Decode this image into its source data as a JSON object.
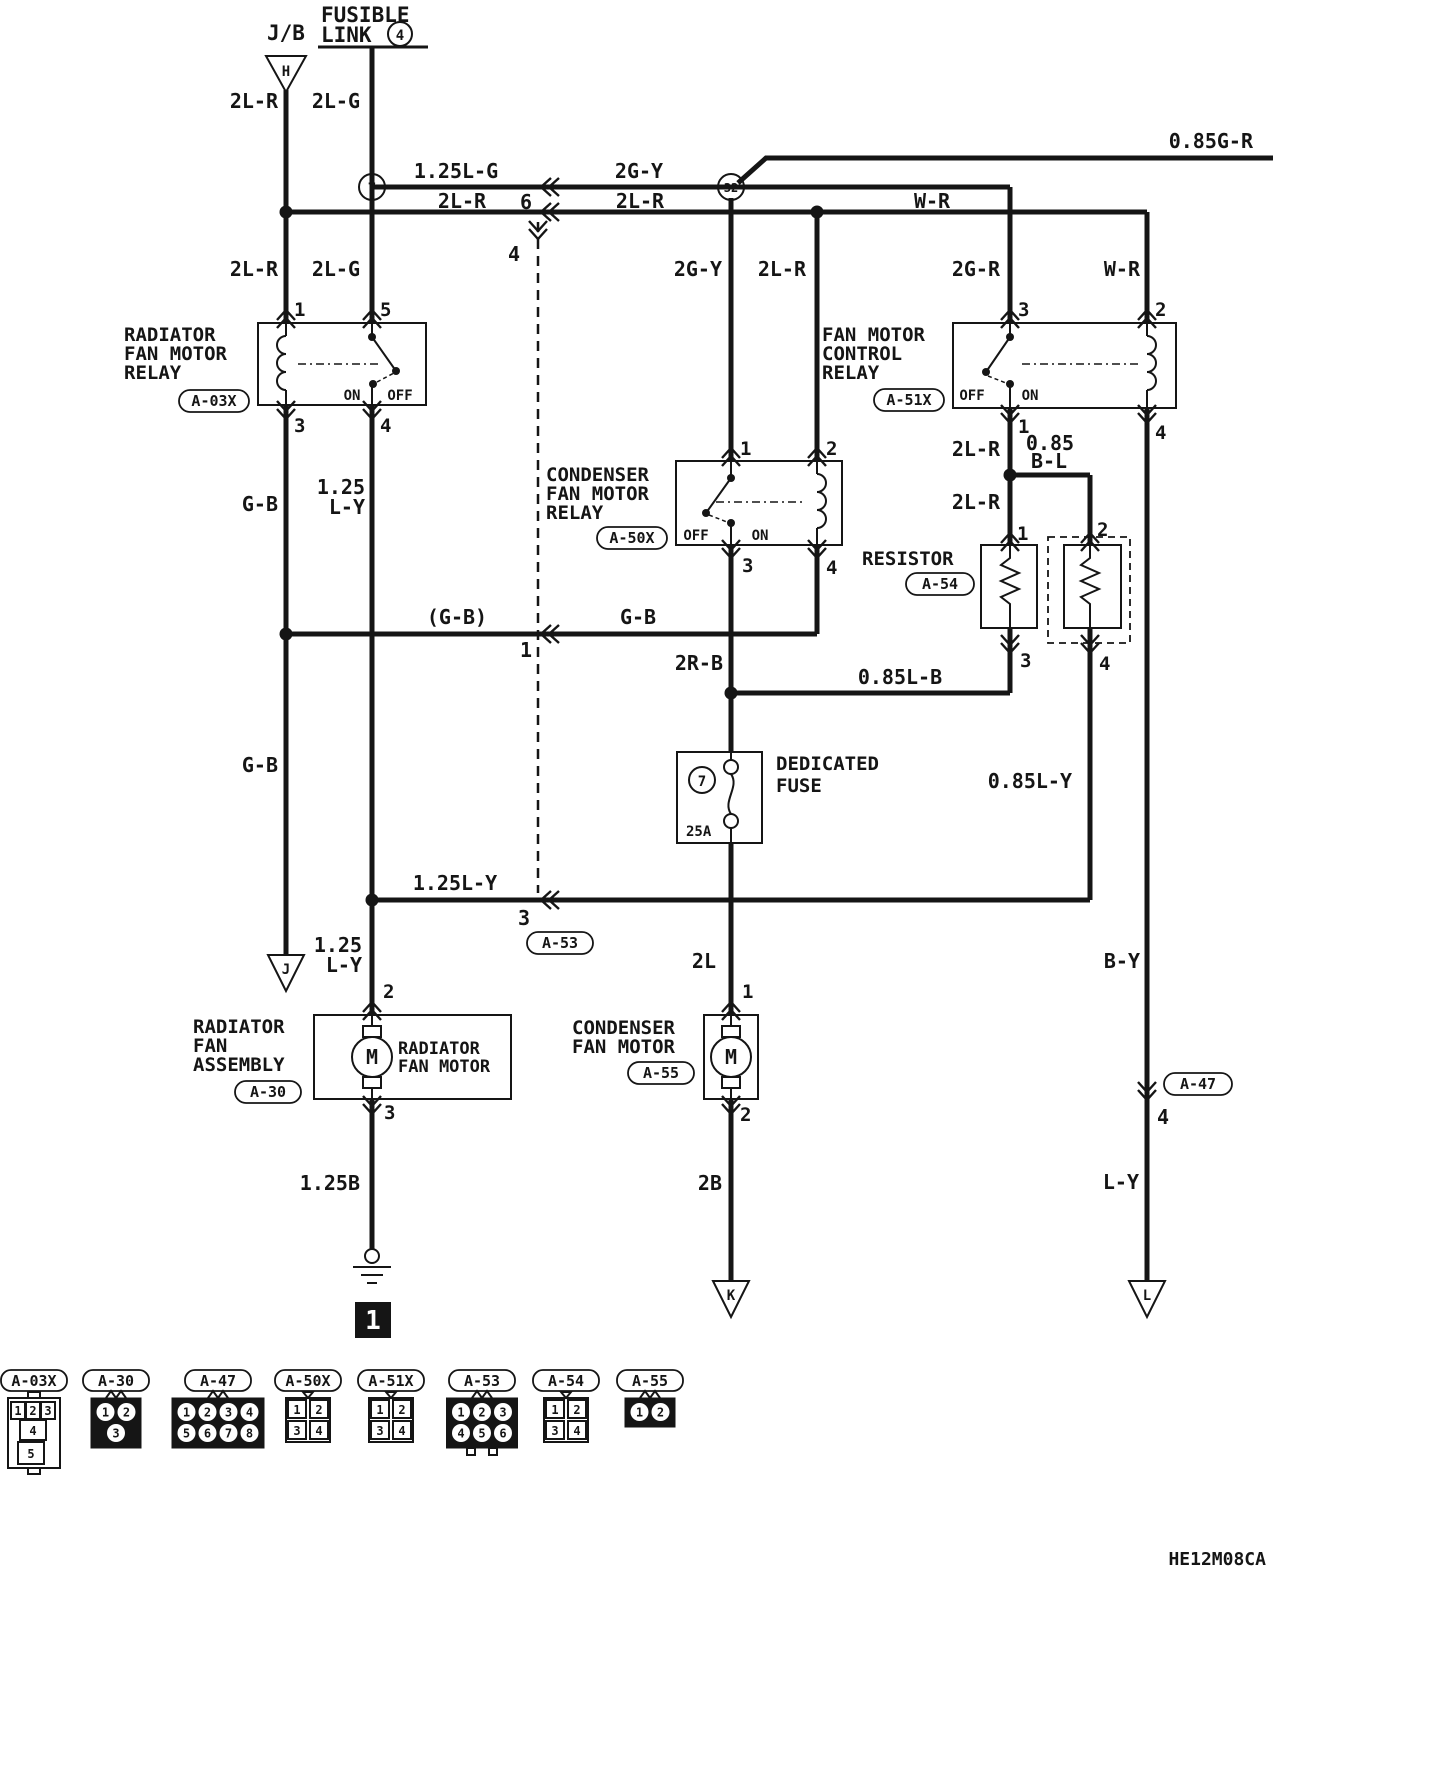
{
  "diagram": {
    "code": "HE12M08CA",
    "jb": "J/B",
    "fusible_line1": "FUSIBLE",
    "fusible_line2": "LINK",
    "fusible_num": "4",
    "junction7": "7",
    "junction32": "32",
    "ground_h": "H",
    "ground_j": "J",
    "ground_k": "K",
    "ground_l": "L",
    "ground_num": "1"
  },
  "wires": {
    "jb_top": "2L-R",
    "fl_top": "2L-G",
    "top_125lg": "1.25L-G",
    "top_2gy": "2G-Y",
    "top_085gr": "0.85G-R",
    "row2_left": "2L-R",
    "row2_right": "2L-R",
    "row2_wr": "W-R",
    "a03x_in1": "2L-R",
    "a03x_in5": "2L-G",
    "a50x_in1": "2G-Y",
    "a50x_in2": "2L-R",
    "a51x_in3": "2G-R",
    "a51x_in2": "W-R",
    "gb_1": "G-B",
    "ly125_a1": "1.25",
    "ly125_a2": "L-Y",
    "a51x_2lr_a": "2L-R",
    "a51x_085": "0.85",
    "a51x_bl": "B-L",
    "a51x_2lr_b": "2L-R",
    "gb_paren": "(G-B)",
    "gb_mid": "G-B",
    "gb_2": "G-B",
    "r2b": "2R-B",
    "lb085": "0.85L-B",
    "ly085": "0.85L-Y",
    "ly125_row": "1.25L-Y",
    "ly125_b1": "1.25",
    "ly125_b2": "L-Y",
    "b125": "1.25B",
    "cond_2l": "2L",
    "b2": "2B",
    "by": "B-Y",
    "ly": "L-Y"
  },
  "crossings": {
    "c6": "6",
    "c4": "4",
    "c1": "1",
    "c3": "3",
    "a53": "A-53",
    "a47": "A-47",
    "a47_pin": "4"
  },
  "components": {
    "a03x": {
      "line1": "RADIATOR",
      "line2": "FAN MOTOR",
      "line3": "RELAY",
      "id": "A-03X",
      "pin1": "1",
      "pin5": "5",
      "pin3": "3",
      "pin4": "4",
      "on": "ON",
      "off": "OFF"
    },
    "a50x": {
      "line1": "CONDENSER",
      "line2": "FAN MOTOR",
      "line3": "RELAY",
      "id": "A-50X",
      "pin1": "1",
      "pin2": "2",
      "pin3": "3",
      "pin4": "4",
      "on": "ON",
      "off": "OFF"
    },
    "a51x": {
      "line1": "FAN MOTOR",
      "line2": "CONTROL",
      "line3": "RELAY",
      "id": "A-51X",
      "pin3": "3",
      "pin2": "2",
      "pin1": "1",
      "pin4": "4",
      "on": "ON",
      "off": "OFF"
    },
    "resistor": {
      "name": "RESISTOR",
      "id": "A-54",
      "pin1": "1",
      "pin2": "2",
      "pin3": "3",
      "pin4": "4"
    },
    "fuse": {
      "line1": "DEDICATED",
      "line2": "FUSE",
      "num": "7",
      "rating": "25A"
    },
    "a30": {
      "line1": "RADIATOR",
      "line2": "FAN",
      "line3": "ASSEMBLY",
      "id": "A-30",
      "motor_line1": "RADIATOR",
      "motor_line2": "FAN MOTOR",
      "m": "M",
      "pin2": "2",
      "pin3": "3"
    },
    "a55": {
      "line1": "CONDENSER",
      "line2": "FAN MOTOR",
      "id": "A-55",
      "m": "M",
      "pin1": "1",
      "pin2": "2"
    }
  },
  "legend": {
    "items": [
      {
        "id": "A-03X",
        "type": "relay5",
        "rows": [
          [
            "1",
            "2",
            "3"
          ],
          [
            "4"
          ],
          [
            "5"
          ]
        ],
        "dark": false
      },
      {
        "id": "A-30",
        "type": "round",
        "rows": [
          [
            "1",
            "2"
          ],
          [
            "3"
          ]
        ],
        "dark": true
      },
      {
        "id": "A-47",
        "type": "round",
        "rows": [
          [
            "1",
            "2",
            "3",
            "4"
          ],
          [
            "5",
            "6",
            "7",
            "8"
          ]
        ],
        "dark": true
      },
      {
        "id": "A-50X",
        "type": "square",
        "rows": [
          [
            "1",
            "2"
          ],
          [
            "3",
            "4"
          ]
        ],
        "dark": false
      },
      {
        "id": "A-51X",
        "type": "square",
        "rows": [
          [
            "1",
            "2"
          ],
          [
            "3",
            "4"
          ]
        ],
        "dark": false
      },
      {
        "id": "A-53",
        "type": "round",
        "rows": [
          [
            "1",
            "2",
            "3"
          ],
          [
            "4",
            "5",
            "6"
          ]
        ],
        "dark": true
      },
      {
        "id": "A-54",
        "type": "square",
        "rows": [
          [
            "1",
            "2"
          ],
          [
            "3",
            "4"
          ]
        ],
        "dark": false
      },
      {
        "id": "A-55",
        "type": "round",
        "rows": [
          [
            "1",
            "2"
          ]
        ],
        "dark": true
      }
    ]
  }
}
